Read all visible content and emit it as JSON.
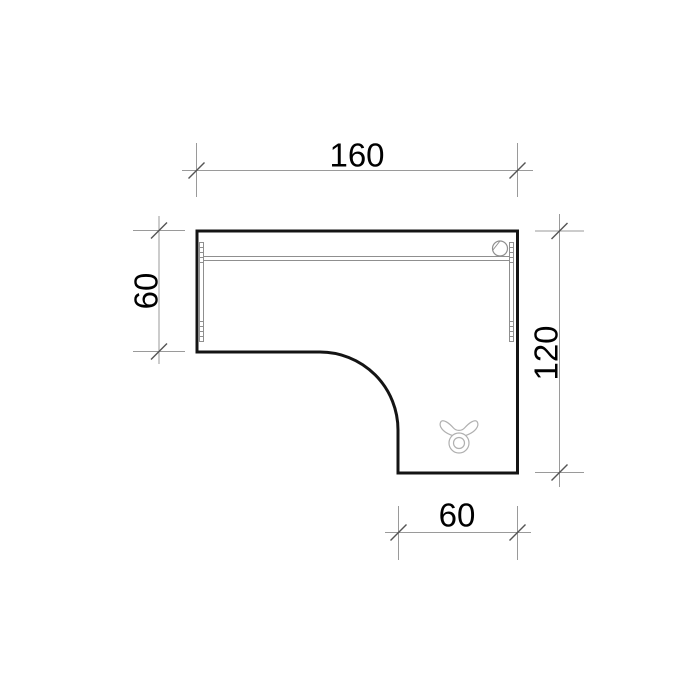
{
  "drawing": {
    "dimensions": {
      "top_width": "160",
      "left_depth": "60",
      "right_depth": "120",
      "bottom_width": "60"
    },
    "icons": {
      "grommet": "cable-grommet-icon",
      "symbol": "taurus-symbol-icon"
    },
    "colors": {
      "background": "#ffffff",
      "outline": "#141414",
      "dim_line": "#9a9a9a",
      "detail_line": "#8f8f8f",
      "tick": "#555555",
      "symbol": "#b0b0b0",
      "text": "#000000"
    }
  }
}
